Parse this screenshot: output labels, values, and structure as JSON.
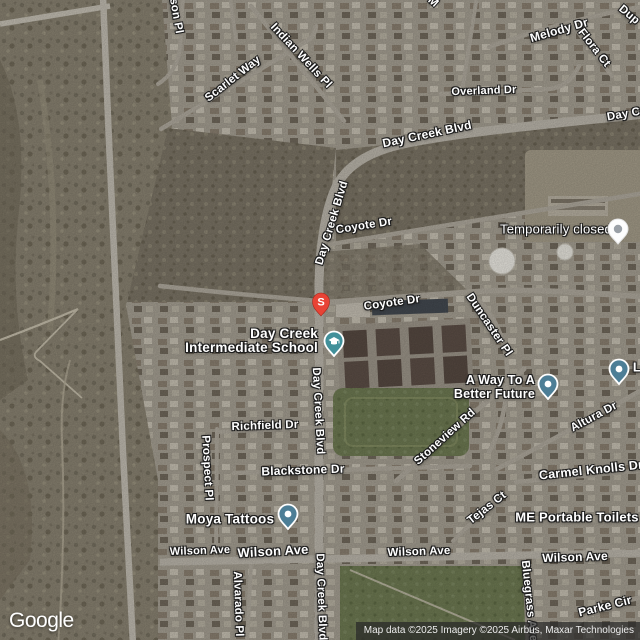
{
  "logo": {
    "text": "Google"
  },
  "attribution": {
    "text": "Map data ©2025 Imagery ©2025 Airbus, Maxar Technologies"
  },
  "colors": {
    "poi_pin": "#4d7e96",
    "school_pin": "#41909a",
    "s_marker_red": "#e84335",
    "closed_pin_dot": "#9aa0a6",
    "label_text": "#ffffff"
  },
  "pins": {
    "s_marker": {
      "letter": "S"
    },
    "school": {
      "line1": "Day Creek",
      "line2": "Intermediate School"
    },
    "temporarily_closed": {
      "text": "Temporarily closed"
    },
    "a_way": {
      "line1": "A Way To A",
      "line2": "Better Future"
    },
    "moya": {
      "text": "Moya Tattoos"
    },
    "me_portable": {
      "text": "ME Portable Toilets"
    },
    "edge_poi": {
      "text": "L"
    }
  },
  "road_labels": [
    {
      "text": "son Pl"
    },
    {
      "text": "Scarlet Way"
    },
    {
      "text": "Indian Wells Pl"
    },
    {
      "text": "Melody Dr"
    },
    {
      "text": "Flora Ct"
    },
    {
      "text": "Dup"
    },
    {
      "text": "Overland Dr"
    },
    {
      "text": "Day Creek Blvd"
    },
    {
      "text": "Day Creek Blvd"
    },
    {
      "text": "Coyote Dr"
    },
    {
      "text": "Day Creek Blvd"
    },
    {
      "text": "Coyote Dr"
    },
    {
      "text": "Duncaster Pl"
    },
    {
      "text": "Day Creek Blvd"
    },
    {
      "text": "Stoneview Rd"
    },
    {
      "text": "Altura Dr"
    },
    {
      "text": "Richfield Dr"
    },
    {
      "text": "Blackstone Dr"
    },
    {
      "text": "Prospect Pl"
    },
    {
      "text": "Carmel Knolls Dr"
    },
    {
      "text": "Tejas Ct"
    },
    {
      "text": "Wilson Ave"
    },
    {
      "text": "Wilson Ave"
    },
    {
      "text": "Wilson Ave"
    },
    {
      "text": "Wilson Ave"
    },
    {
      "text": "Alvarado Pl"
    },
    {
      "text": "Day Creek Blvd"
    },
    {
      "text": "Bluegrass Ave"
    },
    {
      "text": "Parke Cir"
    },
    {
      "text": "M"
    }
  ]
}
